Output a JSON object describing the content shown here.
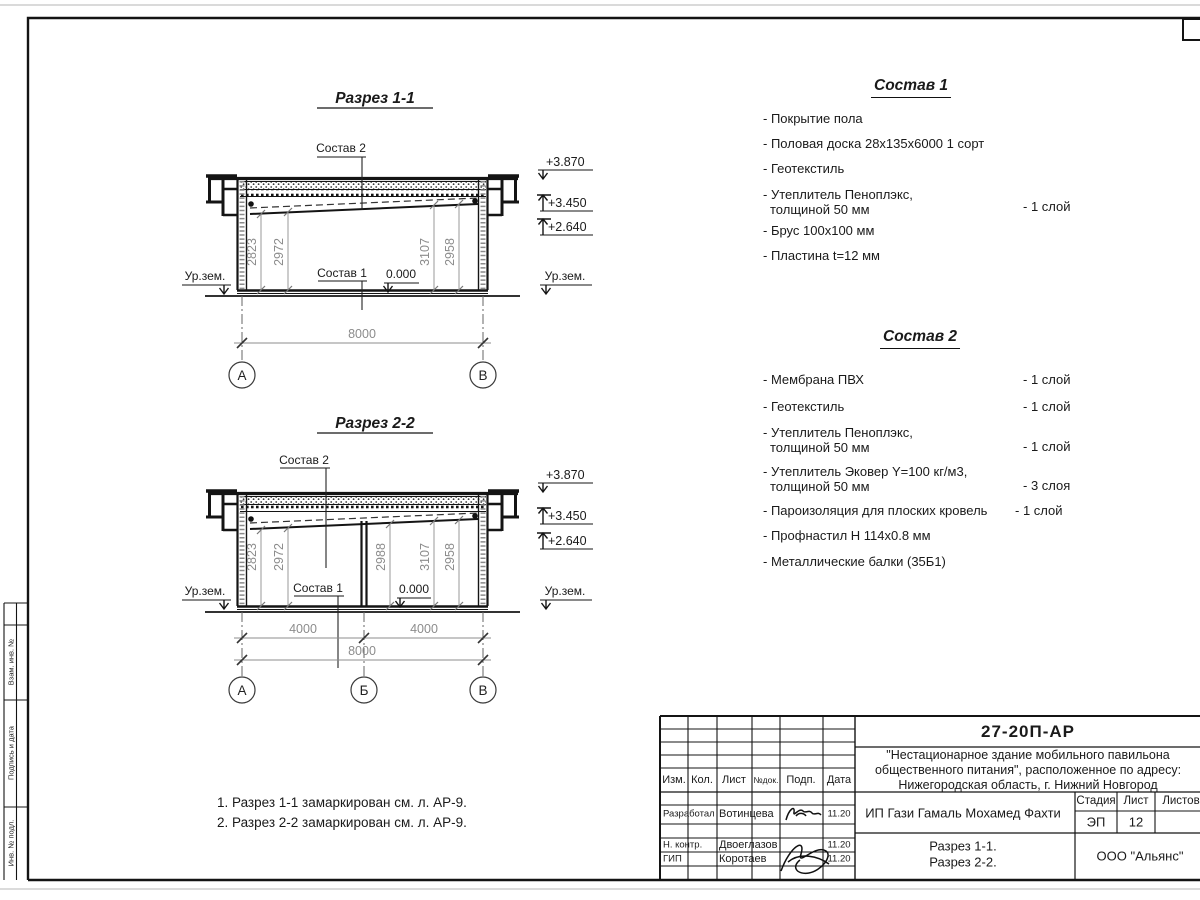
{
  "sheet": {
    "stamp_left": {
      "boxes": [
        "Взам. инв. №",
        "Подпись и дата",
        "Инв. № подл."
      ]
    },
    "notes": {
      "line1": "1. Разрез 1-1 замаркирован см. л. АР-9.",
      "line2": "2. Разрез 2-2 замаркирован см. л. АР-9."
    }
  },
  "section1": {
    "title": "Разрез 1-1",
    "labels": {
      "sostav2": "Состав 2",
      "sostav1": "Состав 1",
      "zero": "0.000",
      "ground_left": "Ур.зем.",
      "ground_right": "Ур.зем."
    },
    "elevations": {
      "top": "+3.870",
      "mid": "+3.450",
      "low": "+2.640"
    },
    "vdims": [
      "2823",
      "2972",
      "3107",
      "2958"
    ],
    "hdims": {
      "total": "8000"
    },
    "axes": [
      "А",
      "В"
    ]
  },
  "section2": {
    "title": "Разрез 2-2",
    "labels": {
      "sostav2": "Состав 2",
      "sostav1": "Состав 1",
      "zero": "0.000",
      "ground_left": "Ур.зем.",
      "ground_right": "Ур.зем."
    },
    "elevations": {
      "top": "+3.870",
      "mid": "+3.450",
      "low": "+2.640"
    },
    "vdims": [
      "2823",
      "2972",
      "2988",
      "3107",
      "2958"
    ],
    "hdims": {
      "left": "4000",
      "right": "4000",
      "total": "8000"
    },
    "axes": [
      "А",
      "Б",
      "В"
    ]
  },
  "sostav1": {
    "title": "Состав 1",
    "items": [
      {
        "line1": "- Покрытие пола",
        "line2": "",
        "qty": ""
      },
      {
        "line1": "- Половая доска 28х135х6000 1 сорт",
        "line2": "",
        "qty": ""
      },
      {
        "line1": "- Геотекстиль",
        "line2": "",
        "qty": ""
      },
      {
        "line1": "- Утеплитель Пеноплэкс,",
        "line2": "толщиной 50 мм",
        "qty": "- 1 слой"
      },
      {
        "line1": "- Брус 100х100 мм",
        "line2": "",
        "qty": ""
      },
      {
        "line1": "- Пластина t=12 мм",
        "line2": "",
        "qty": ""
      }
    ]
  },
  "sostav2": {
    "title": "Состав 2",
    "items": [
      {
        "line1": "- Мембрана ПВХ",
        "line2": "",
        "qty": "- 1 слой"
      },
      {
        "line1": "- Геотекстиль",
        "line2": "",
        "qty": "- 1 слой"
      },
      {
        "line1": "- Утеплитель Пеноплэкс,",
        "line2": "толщиной 50 мм",
        "qty": "- 1 слой"
      },
      {
        "line1": "- Утеплитель Эковер Y=100 кг/м3,",
        "line2": "толщиной 50 мм",
        "qty": "- 3 слоя"
      },
      {
        "line1": "- Пароизоляция для плоских кровель",
        "line2": "",
        "qty": "- 1 слой"
      },
      {
        "line1": "- Профнастил Н 114х0.8 мм",
        "line2": "",
        "qty": ""
      },
      {
        "line1": "- Металлические балки (35Б1)",
        "line2": "",
        "qty": ""
      }
    ]
  },
  "titleblock": {
    "code": "27-20П-АР",
    "project": {
      "line1": "\"Нестационарное здание мобильного павильона",
      "line2": "общественного питания\", расположенное по адресу:",
      "line3": "Нижегородская область, г. Нижний Новгород"
    },
    "client": "ИП Гази Гамаль Мохамед Фахти",
    "drawing_title": {
      "line1": "Разрез 1-1.",
      "line2": "Разрез 2-2."
    },
    "organization": "ООО \"Альянс\"",
    "stage": {
      "label": "Стадия",
      "value": "ЭП"
    },
    "sheet_no": {
      "label": "Лист",
      "value": "12"
    },
    "sheets_total": {
      "label": "Листов",
      "value": ""
    },
    "header_cols": [
      "Изм.",
      "Кол.",
      "Лист",
      "№док.",
      "Подп.",
      "Дата"
    ],
    "signature_rows": [
      {
        "role": "Разработал",
        "name": "Вотинцева",
        "date": "11.20"
      },
      {
        "role": "Н. контр.",
        "name": "Двоеглазов",
        "date": "11.20"
      },
      {
        "role": "ГИП",
        "name": "Коротаев",
        "date": "11.20"
      }
    ]
  }
}
